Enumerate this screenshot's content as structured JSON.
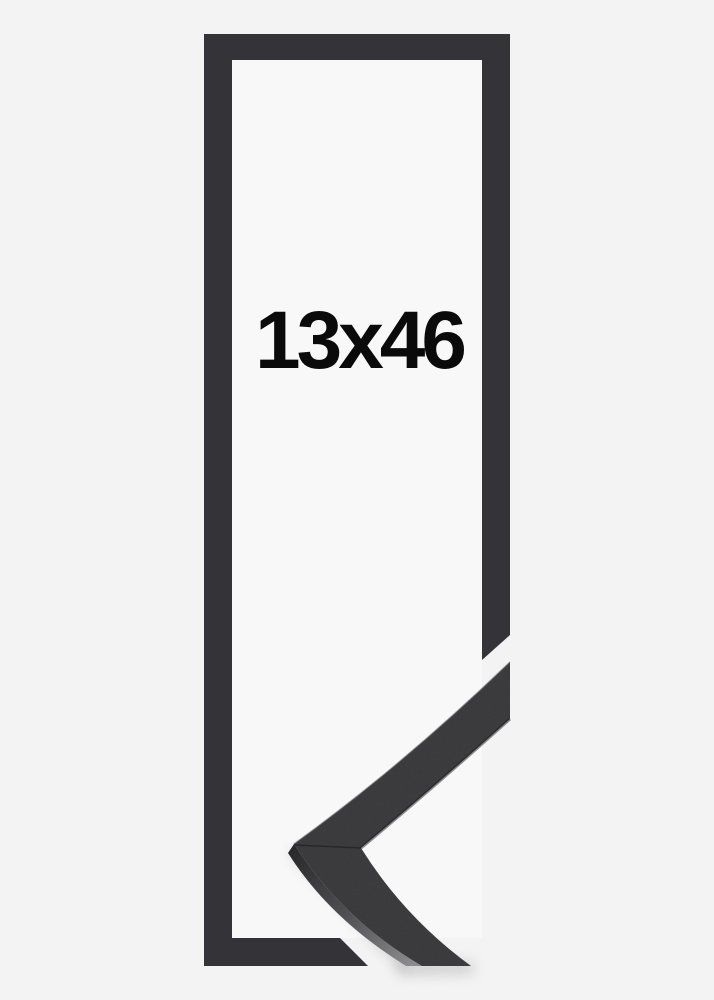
{
  "product": {
    "size_label": "13x46"
  },
  "theme": {
    "bg": "#f3f3f3",
    "window": "#f8f8f8",
    "frame": "#343438",
    "sample-face": "#38383b",
    "side-dark": "#252528",
    "side-mid": "#4c4c50",
    "side-light": "#8a8a8d",
    "label": "#0a0a0a"
  }
}
